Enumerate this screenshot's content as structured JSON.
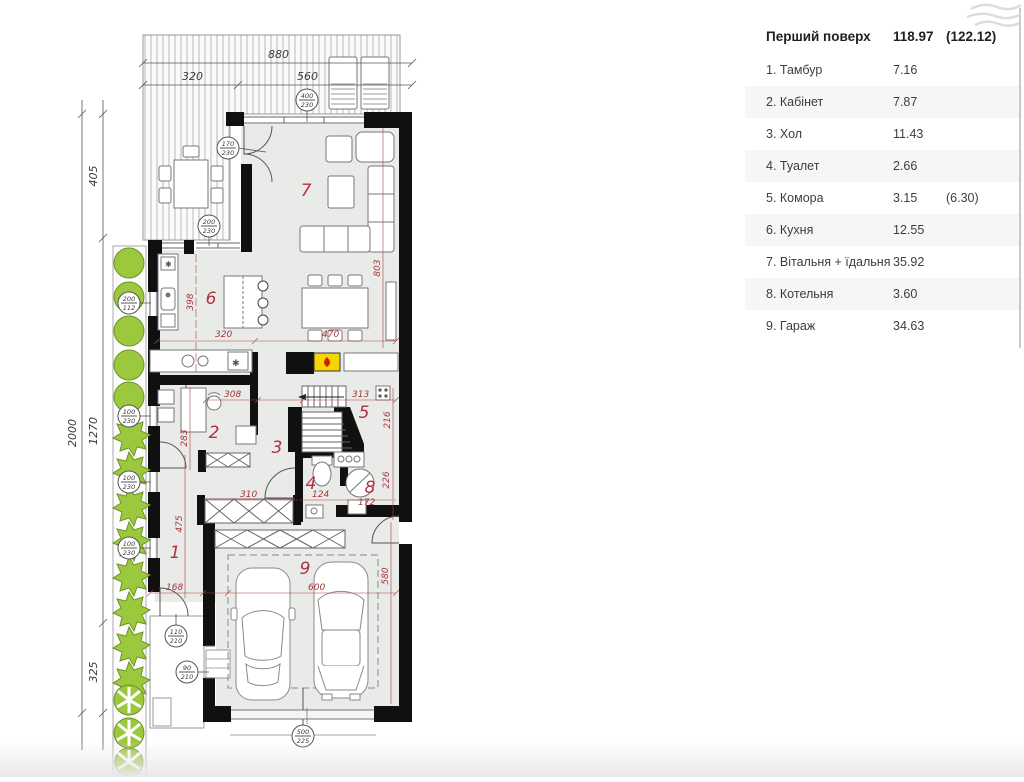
{
  "table": {
    "header": {
      "label": "Перший поверх",
      "area": "118.97",
      "area_alt": "(122.12)"
    },
    "rows": [
      {
        "label": "1. Тамбур",
        "area": "7.16",
        "area_alt": ""
      },
      {
        "label": "2. Кабінет",
        "area": "7.87",
        "area_alt": ""
      },
      {
        "label": "3. Хол",
        "area": "11.43",
        "area_alt": ""
      },
      {
        "label": "4. Туалет",
        "area": "2.66",
        "area_alt": ""
      },
      {
        "label": "5. Комора",
        "area": "3.15",
        "area_alt": "(6.30)"
      },
      {
        "label": "6. Кухня",
        "area": "12.55",
        "area_alt": ""
      },
      {
        "label": "7. Вітальня + їдальня",
        "area": "35.92",
        "area_alt": ""
      },
      {
        "label": "8. Котельня",
        "area": "3.60",
        "area_alt": ""
      },
      {
        "label": "9. Гараж",
        "area": "34.63",
        "area_alt": ""
      }
    ]
  },
  "plan": {
    "top_dims": [
      "880",
      "320",
      "560"
    ],
    "left_dims": [
      "2000",
      "405",
      "1270",
      "325"
    ],
    "red_dims": [
      "398",
      "320",
      "470",
      "803",
      "308",
      "313",
      "216",
      "283",
      "310",
      "124",
      "172",
      "226",
      "475",
      "168",
      "600",
      "580"
    ],
    "room_numbers": [
      "1",
      "2",
      "3",
      "4",
      "5",
      "6",
      "7",
      "8",
      "9"
    ],
    "stamps": [
      {
        "top": "400",
        "bottom": "230"
      },
      {
        "top": "170",
        "bottom": "230"
      },
      {
        "top": "200",
        "bottom": "230"
      },
      {
        "top": "200",
        "bottom": "112"
      },
      {
        "top": "100",
        "bottom": "230"
      },
      {
        "top": "100",
        "bottom": "230"
      },
      {
        "top": "100",
        "bottom": "230"
      },
      {
        "top": "110",
        "bottom": "210"
      },
      {
        "top": "90",
        "bottom": "210"
      },
      {
        "top": "500",
        "bottom": "225"
      }
    ]
  }
}
